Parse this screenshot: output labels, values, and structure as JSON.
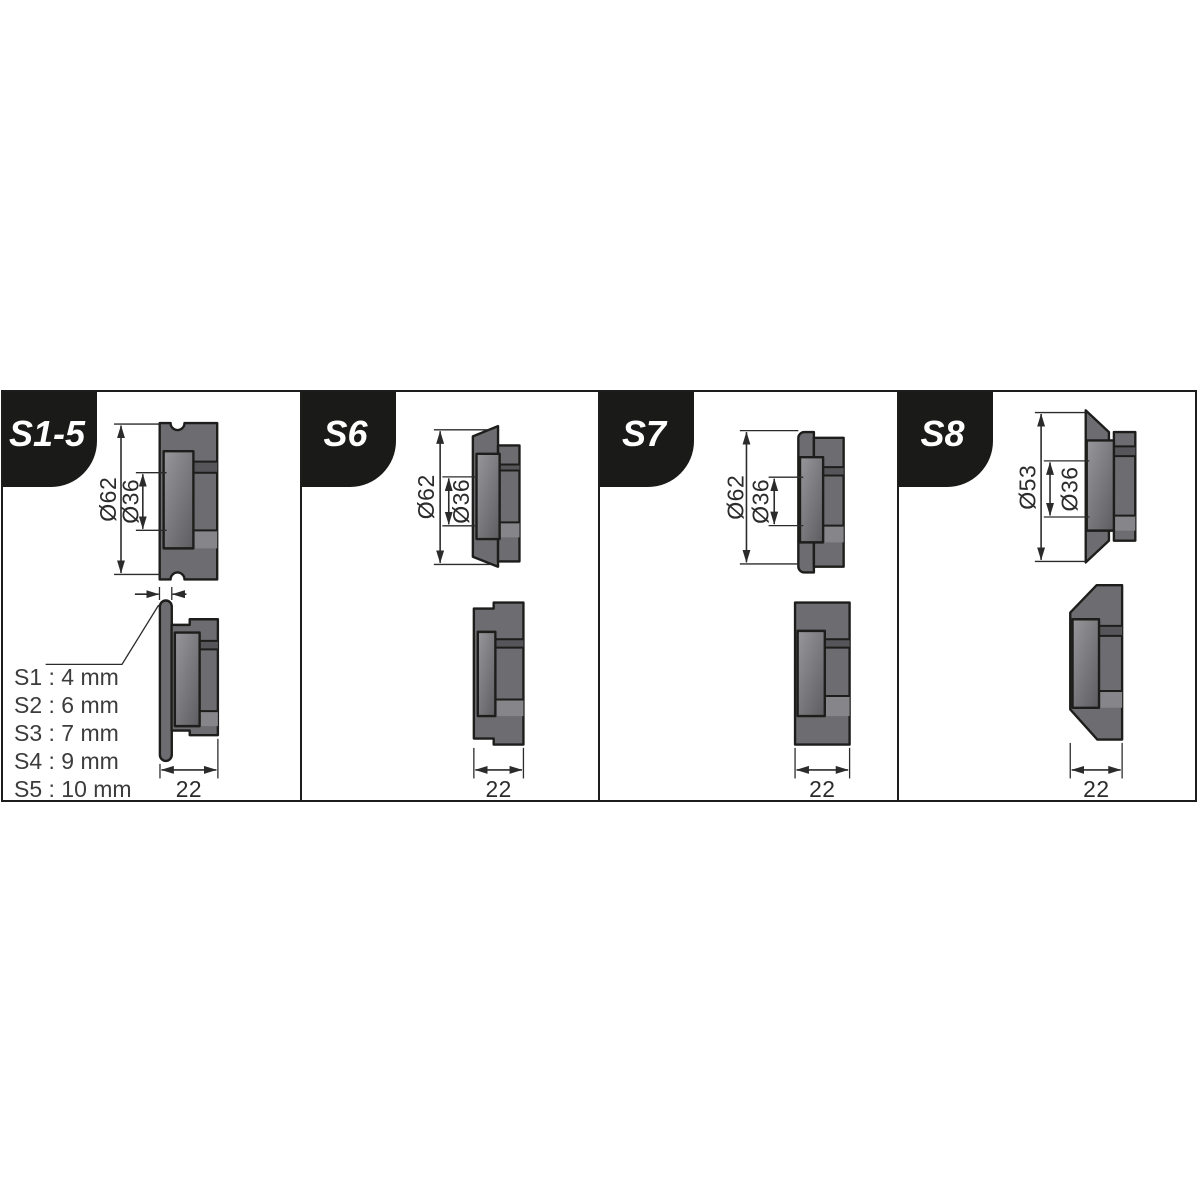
{
  "panels": [
    {
      "tab": "S1-5",
      "outer_diameter": "Ø62",
      "inner_diameter": "Ø36",
      "width": "22",
      "gap_options": [
        "S1 : 4 mm",
        "S2 : 6 mm",
        "S3 : 7 mm",
        "S4 : 9 mm",
        "S5 : 10 mm"
      ]
    },
    {
      "tab": "S6",
      "outer_diameter": "Ø62",
      "inner_diameter": "Ø36",
      "width": "22"
    },
    {
      "tab": "S7",
      "outer_diameter": "Ø62",
      "inner_diameter": "Ø36",
      "width": "22"
    },
    {
      "tab": "S8",
      "outer_diameter": "Ø53",
      "inner_diameter": "Ø36",
      "width": "22"
    }
  ],
  "colors": {
    "background": "#ffffff",
    "line": "#1d1d1b",
    "tab_bg": "#1a1a18",
    "tab_text": "#ffffff",
    "body_fill": "#6d6d71",
    "hub_light": "#97979b",
    "hub_dark": "#606064",
    "band_dark": "#56565a",
    "band_light": "#85858a",
    "dim": "#2b2b2b"
  }
}
